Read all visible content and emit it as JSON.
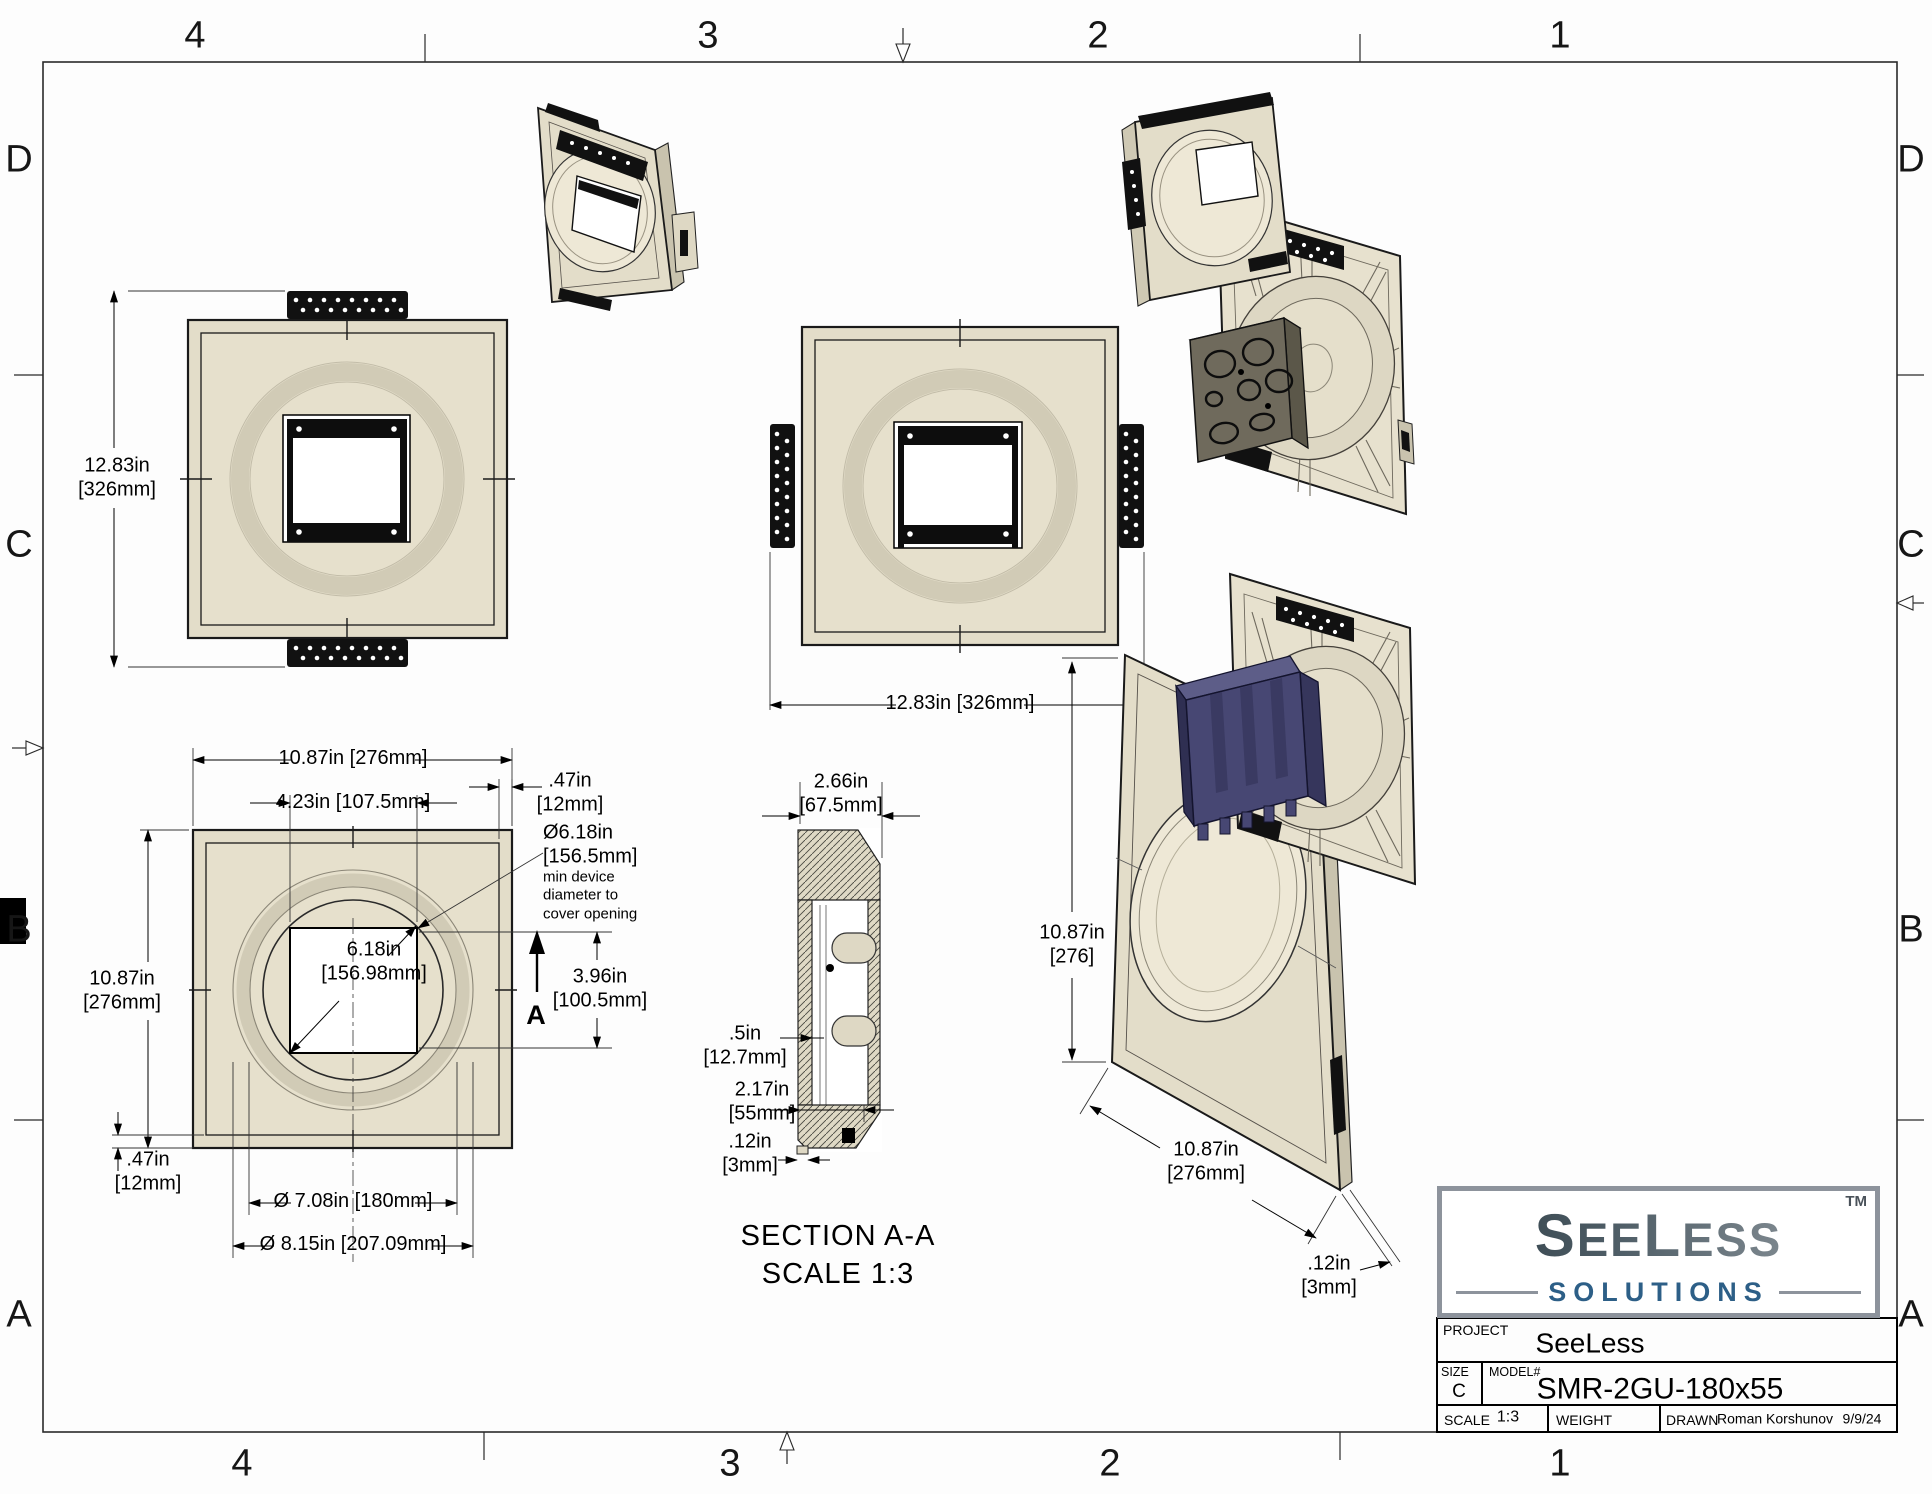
{
  "sheet": {
    "kind": "engineering-drawing",
    "size": "C"
  },
  "border": {
    "cols": [
      "4",
      "3",
      "2",
      "1"
    ],
    "rows": [
      "D",
      "C",
      "B",
      "A"
    ]
  },
  "dims": {
    "plate_full_height": "12.83in\n[326mm]",
    "plate_full_width": "12.83in [326mm]",
    "front_width": "10.87in [276mm]",
    "front_opening_width": "4.23in [107.5mm]",
    "front_rim_top": ".47in\n[12mm]",
    "min_device_dia": "Ø6.18in\n[156.5mm]",
    "min_device_note": "min device\ndiameter to\ncover opening",
    "opening_diagonal": "6.18in\n[156.98mm]",
    "front_height": "10.87in\n[276mm]",
    "opening_height": "3.96in\n[100.5mm]",
    "front_rim_bottom": ".47in\n[12mm]",
    "dia_inner": "Ø 7.08in [180mm]",
    "dia_outer": "Ø 8.15in [207.09mm]",
    "section_width": "2.66in\n[67.5mm]",
    "section_lip": ".5in\n[12.7mm]",
    "section_box_depth": "2.17in\n[55mm]",
    "section_tip": ".12in\n[3mm]",
    "iso_height": "10.87in\n[276]",
    "iso_width": "10.87in\n[276mm]",
    "iso_tip": ".12in\n[3mm]",
    "section_arrow_letter": "A"
  },
  "section_label": {
    "title": "SECTION A-A",
    "scale": "SCALE 1:3"
  },
  "logo": {
    "s1": "S",
    "s2": "EE",
    "s3": "L",
    "s4": "ESS",
    "tm": "TM",
    "subtitle": "SOLUTIONS"
  },
  "title_block": {
    "project_label": "PROJECT",
    "project_value": "SeeLess",
    "size_label": "SIZE",
    "size_value": "C",
    "model_label": "MODEL#",
    "model_value": "SMR-2GU-180x55",
    "scale_label": "SCALE",
    "scale_value": "1:3",
    "weight_label": "WEIGHT",
    "drawn_label": "DRAWN",
    "drawn_value": "Roman Korshunov",
    "date_value": "9/9/24"
  },
  "colors": {
    "plate_beige": "#e3ddc9",
    "ring_gray": "#cdc7b2",
    "bracket_black": "#111111",
    "junction_gray": "#6f6a5c",
    "junction_navy": "#474773",
    "logo_dark": "#2e3d45",
    "logo_light": "#959da3",
    "logo_blue": "#2d5f87"
  }
}
